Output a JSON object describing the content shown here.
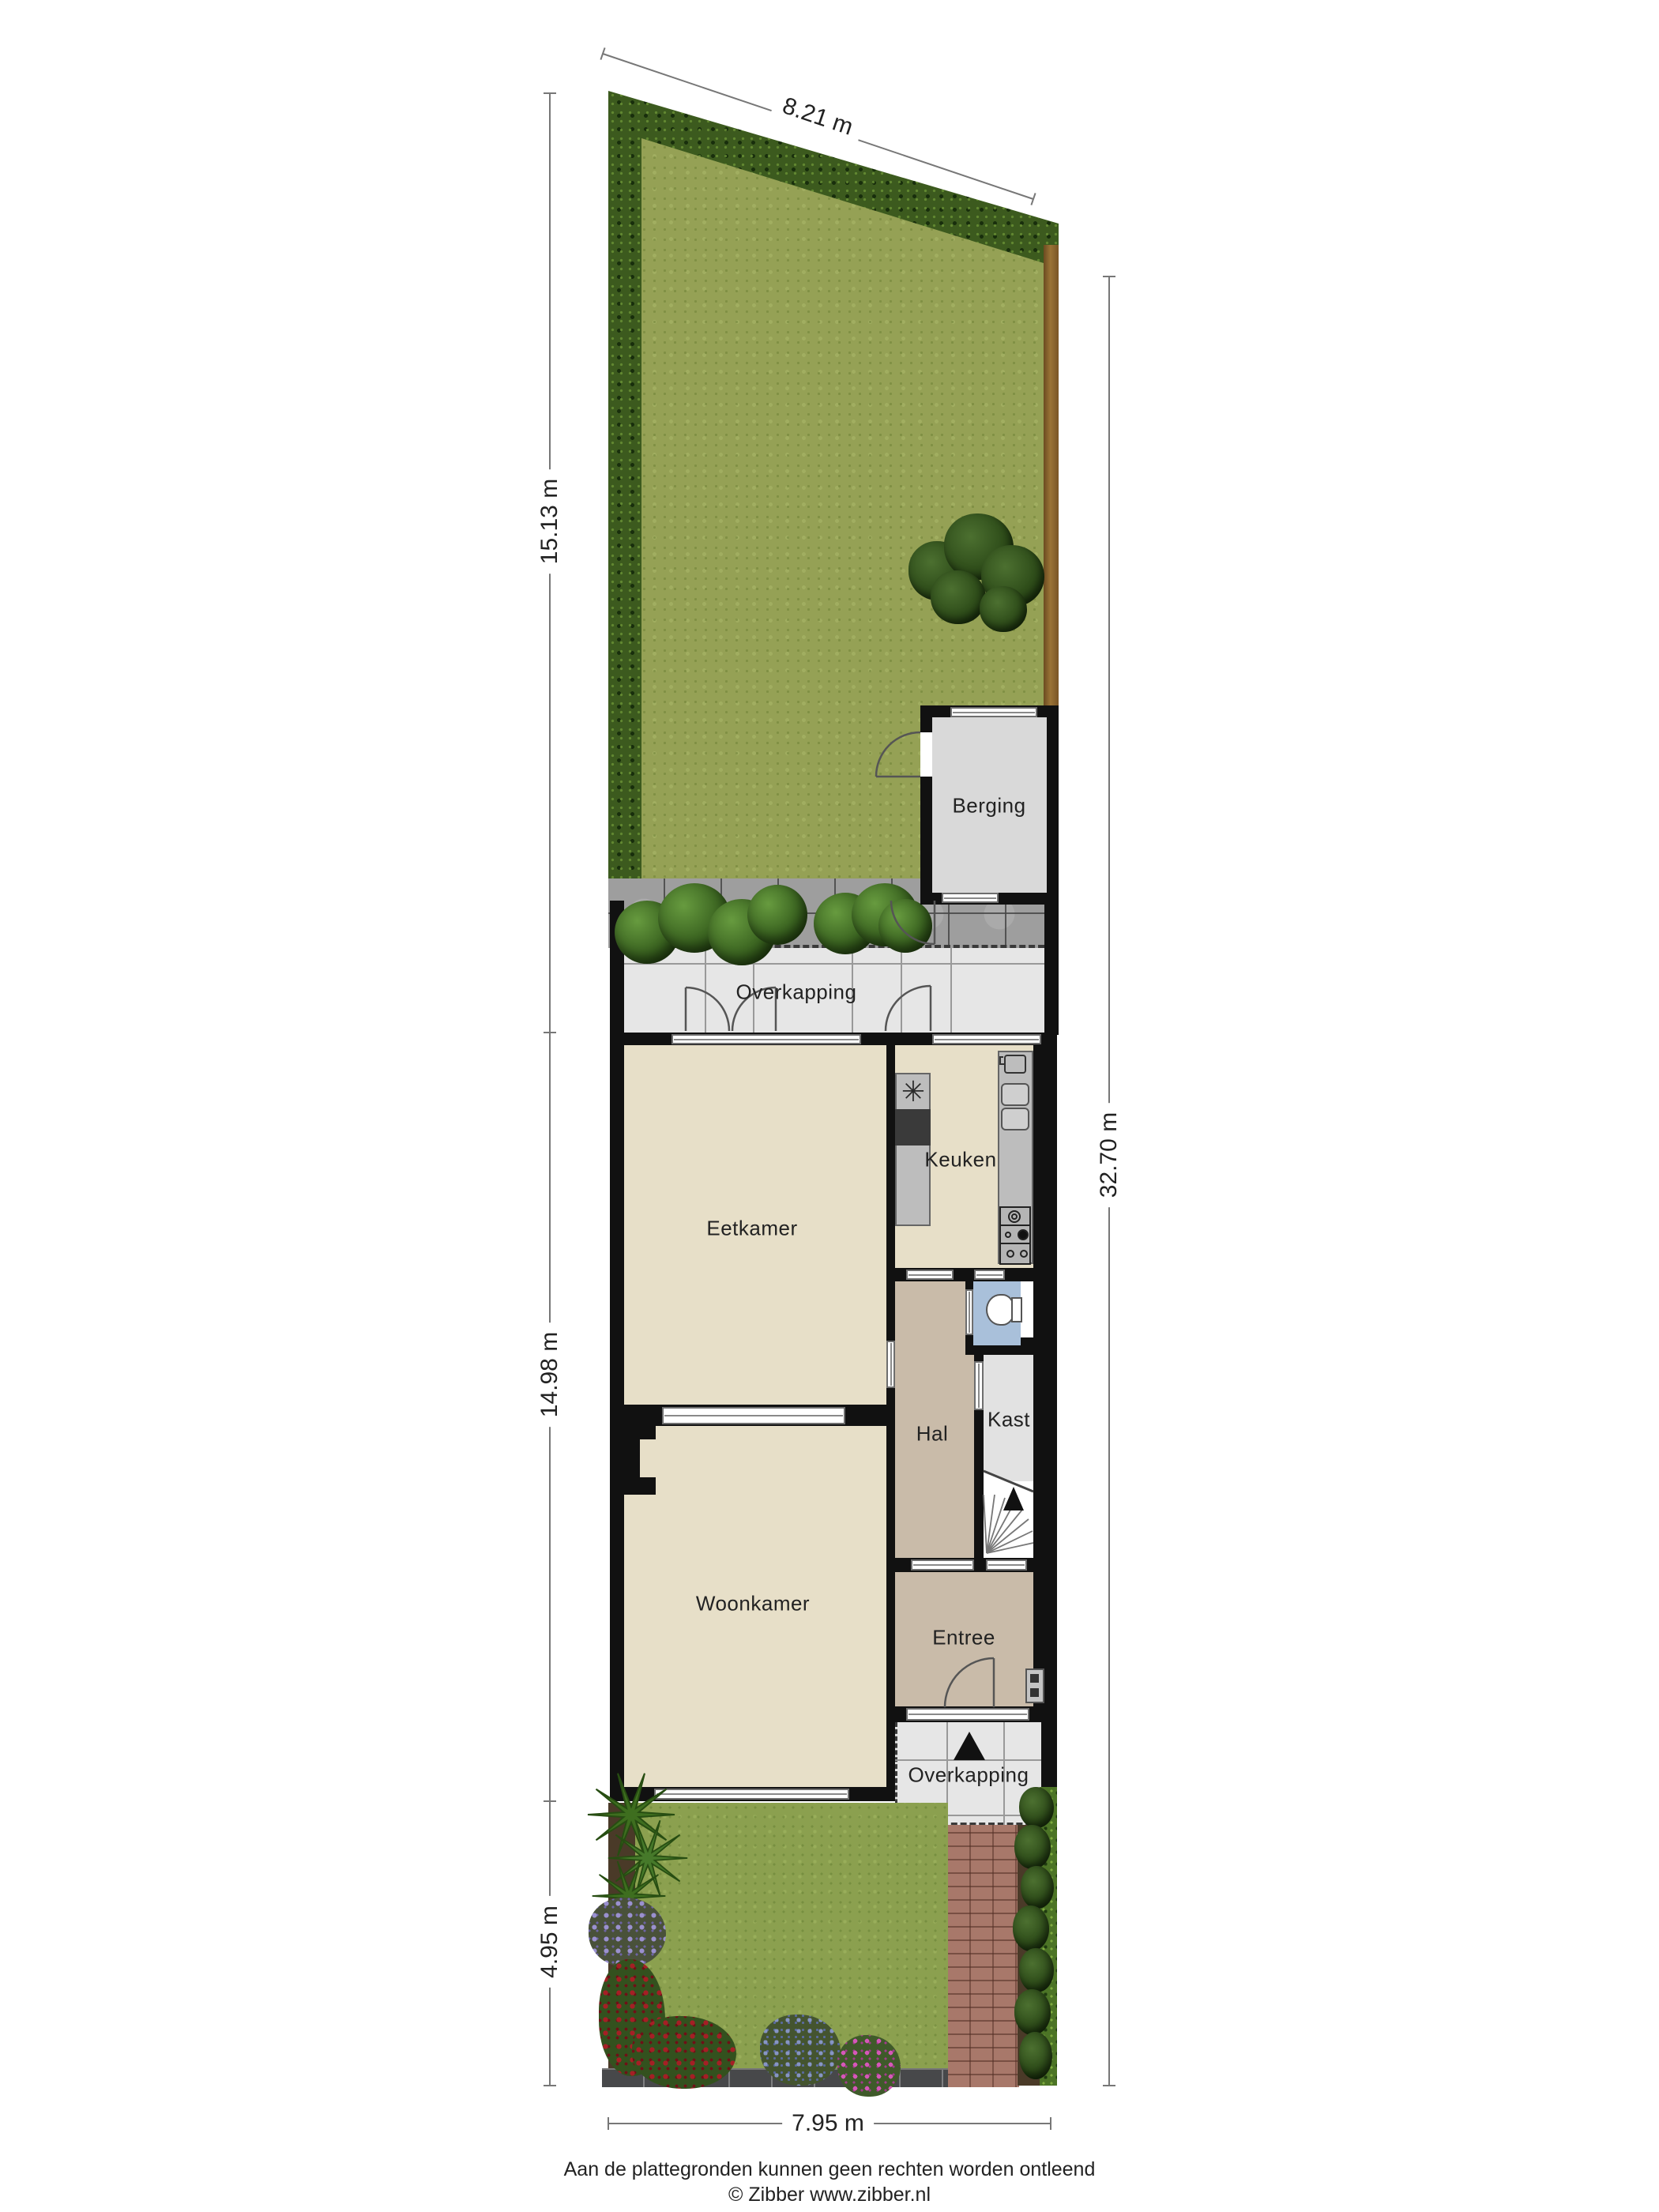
{
  "rooms": {
    "berging": "Berging",
    "overkapping_back": "Overkapping",
    "eetkamer": "Eetkamer",
    "keuken": "Keuken",
    "hal": "Hal",
    "kast": "Kast",
    "woonkamer": "Woonkamer",
    "entree": "Entree",
    "overkapping_front": "Overkapping"
  },
  "dimensions": {
    "top": "8.21 m",
    "left_garden": "15.13 m",
    "left_house": "14.98 m",
    "left_front": "4.95 m",
    "right": "32.70 m",
    "bottom": "7.95 m"
  },
  "footer": {
    "disclaimer": "Aan de plattegronden kunnen geen rechten worden ontleend",
    "credit": "© Zibber www.zibber.nl"
  },
  "colors": {
    "wall": "#111111",
    "beige": "#e7dfc8",
    "taupe": "#c9bba9",
    "blue": "#a9c0da",
    "berging": "#d9d9d9",
    "overkap": "#e6e6e6",
    "lawn": "#95a155",
    "grassfront": "#8ba04f",
    "hedge": "#3c5a1e",
    "fence": "#8a6434",
    "terrace": "#9e9e9e",
    "brick": "#a8786a",
    "curb": "#47484a",
    "counter": "#bdbdbd",
    "stove": "#3a3a3a",
    "text": "#222222"
  }
}
